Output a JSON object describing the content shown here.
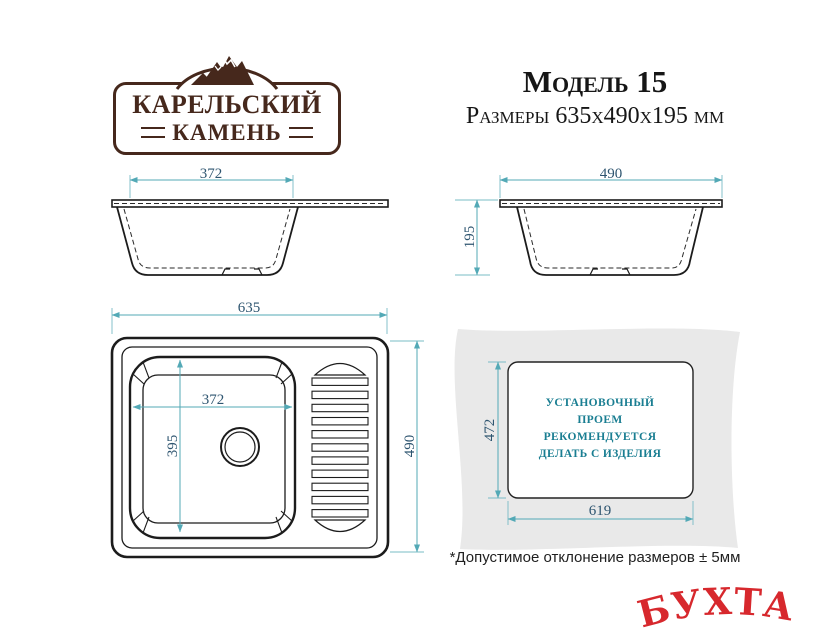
{
  "brand": {
    "line1": "КАРЕЛЬСКИЙ",
    "line2": "КАМЕНЬ"
  },
  "header": {
    "model": "Модель 15",
    "dimensions": "Размеры 635х490х195 мм"
  },
  "views": {
    "front_section": {
      "bowl_width": "372"
    },
    "side_section": {
      "width": "490",
      "height": "195"
    },
    "top": {
      "width": "635",
      "height": "490",
      "bowl_width": "372",
      "bowl_length": "395"
    },
    "cutout": {
      "height": "472",
      "width": "619",
      "note_lines": [
        "УСТАНОВОЧНЫЙ",
        "ПРОЕМ",
        "РЕКОМЕНДУЕТСЯ",
        "ДЕЛАТЬ С ИЗДЕЛИЯ"
      ]
    }
  },
  "footer": {
    "tolerance": "*Допустимое отклонение размеров ± 5мм"
  },
  "watermark": {
    "text": "БУХТА"
  },
  "colors": {
    "outline": "#1c1c1c",
    "dimension_line": "#53a9b6",
    "dimension_text": "#2e5570",
    "note_teal": "#1a7e92",
    "brand_brown": "#46281c",
    "watermark_red": "#d7282d",
    "countertop_gray": "#e9e9e9"
  }
}
